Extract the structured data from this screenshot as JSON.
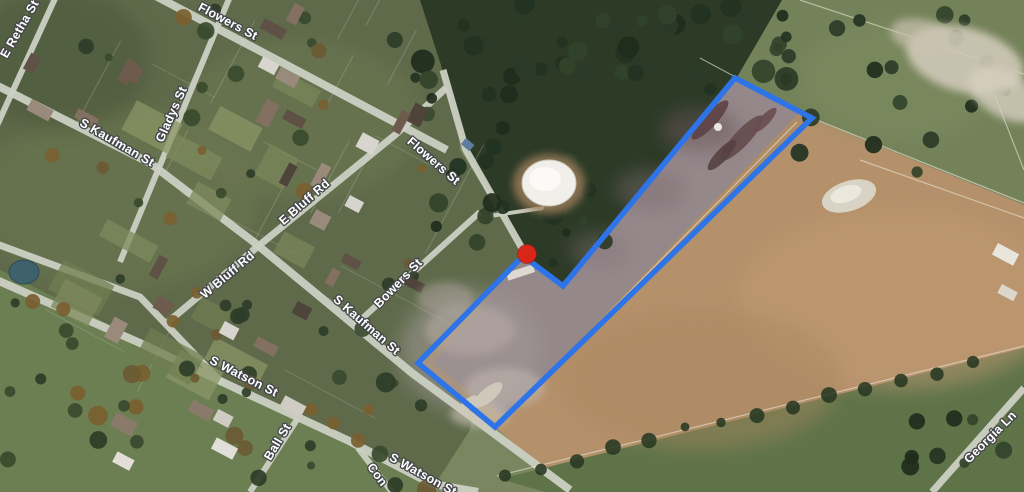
{
  "map": {
    "description": "Aerial satellite map with property boundary overlay",
    "street_labels": [
      {
        "text": "E Retha St",
        "x": 23,
        "y": 31,
        "rot": -60
      },
      {
        "text": "Flowers St",
        "x": 226,
        "y": 25,
        "rot": 28
      },
      {
        "text": "Gladys St",
        "x": 175,
        "y": 116,
        "rot": -66
      },
      {
        "text": "S Kaufman St",
        "x": 115,
        "y": 146,
        "rot": 30
      },
      {
        "text": "E Bluff Rd",
        "x": 307,
        "y": 205,
        "rot": -41
      },
      {
        "text": "W Bluff Rd",
        "x": 230,
        "y": 278,
        "rot": -40
      },
      {
        "text": "Flowers St",
        "x": 431,
        "y": 164,
        "rot": 41
      },
      {
        "text": "Bowers St",
        "x": 401,
        "y": 286,
        "rot": -46
      },
      {
        "text": "S Kaufman St",
        "x": 364,
        "y": 328,
        "rot": 41
      },
      {
        "text": "S Watson St",
        "x": 242,
        "y": 380,
        "rot": 27
      },
      {
        "text": "Ball St",
        "x": 281,
        "y": 444,
        "rot": -59
      },
      {
        "text": "S Watson St",
        "x": 421,
        "y": 478,
        "rot": 29
      },
      {
        "text": "Con",
        "x": 374,
        "y": 477,
        "rot": 54
      },
      {
        "text": "Georgia Ln",
        "x": 993,
        "y": 440,
        "rot": -45
      }
    ],
    "parcel_boundary": {
      "color": "#2e74e9",
      "stroke_width": 5.5,
      "points": [
        [
          735,
          78
        ],
        [
          812,
          118
        ],
        [
          495,
          427
        ],
        [
          418,
          363
        ],
        [
          523,
          256
        ],
        [
          563,
          286
        ]
      ]
    },
    "marker": {
      "color": "#d8271a",
      "x": 527,
      "y": 254,
      "radius": 9.5
    },
    "label_style": {
      "fill": "#ffffff",
      "halo": "#45464a",
      "font_size": 12.5
    }
  }
}
